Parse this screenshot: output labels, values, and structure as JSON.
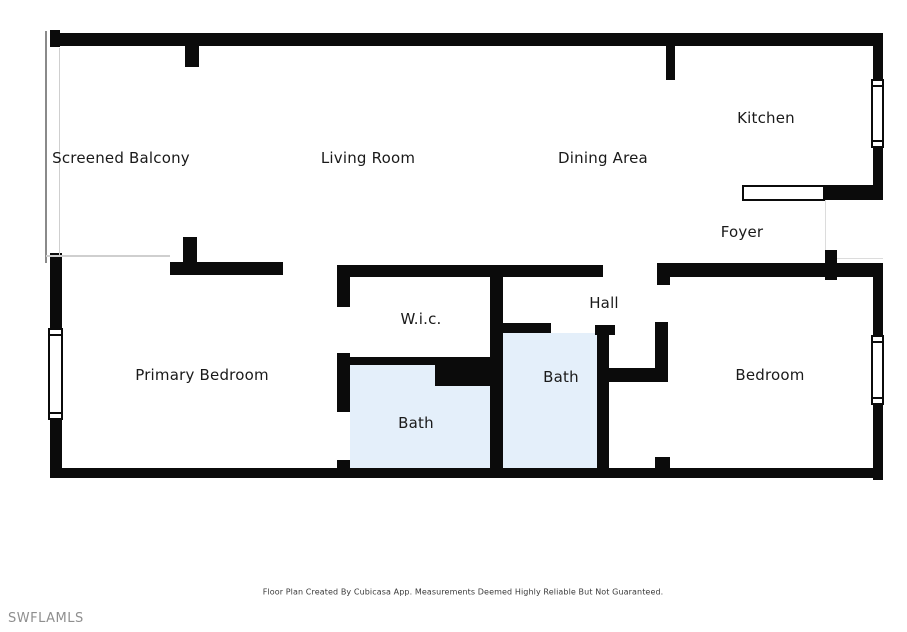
{
  "rooms": {
    "screened_balcony": "Screened Balcony",
    "living_room": "Living Room",
    "dining_area": "Dining Area",
    "kitchen": "Kitchen",
    "foyer": "Foyer",
    "hall": "Hall",
    "wic": "W.i.c.",
    "primary_bedroom": "Primary Bedroom",
    "bath_primary": "Bath",
    "bath_hall": "Bath",
    "bedroom": "Bedroom"
  },
  "footer": {
    "disclaimer": "Floor Plan Created By Cubicasa App. Measurements Deemed Highly Reliable But Not Guaranteed."
  },
  "watermark": "SWFLAMLS",
  "colors": {
    "wall": "#0b0b0b",
    "bath_fill": "#e4effa",
    "background": "#ffffff",
    "label_text": "#1a1a1a",
    "watermark_text": "#8f8f8f",
    "disclaimer_text": "#3a3a3a"
  }
}
